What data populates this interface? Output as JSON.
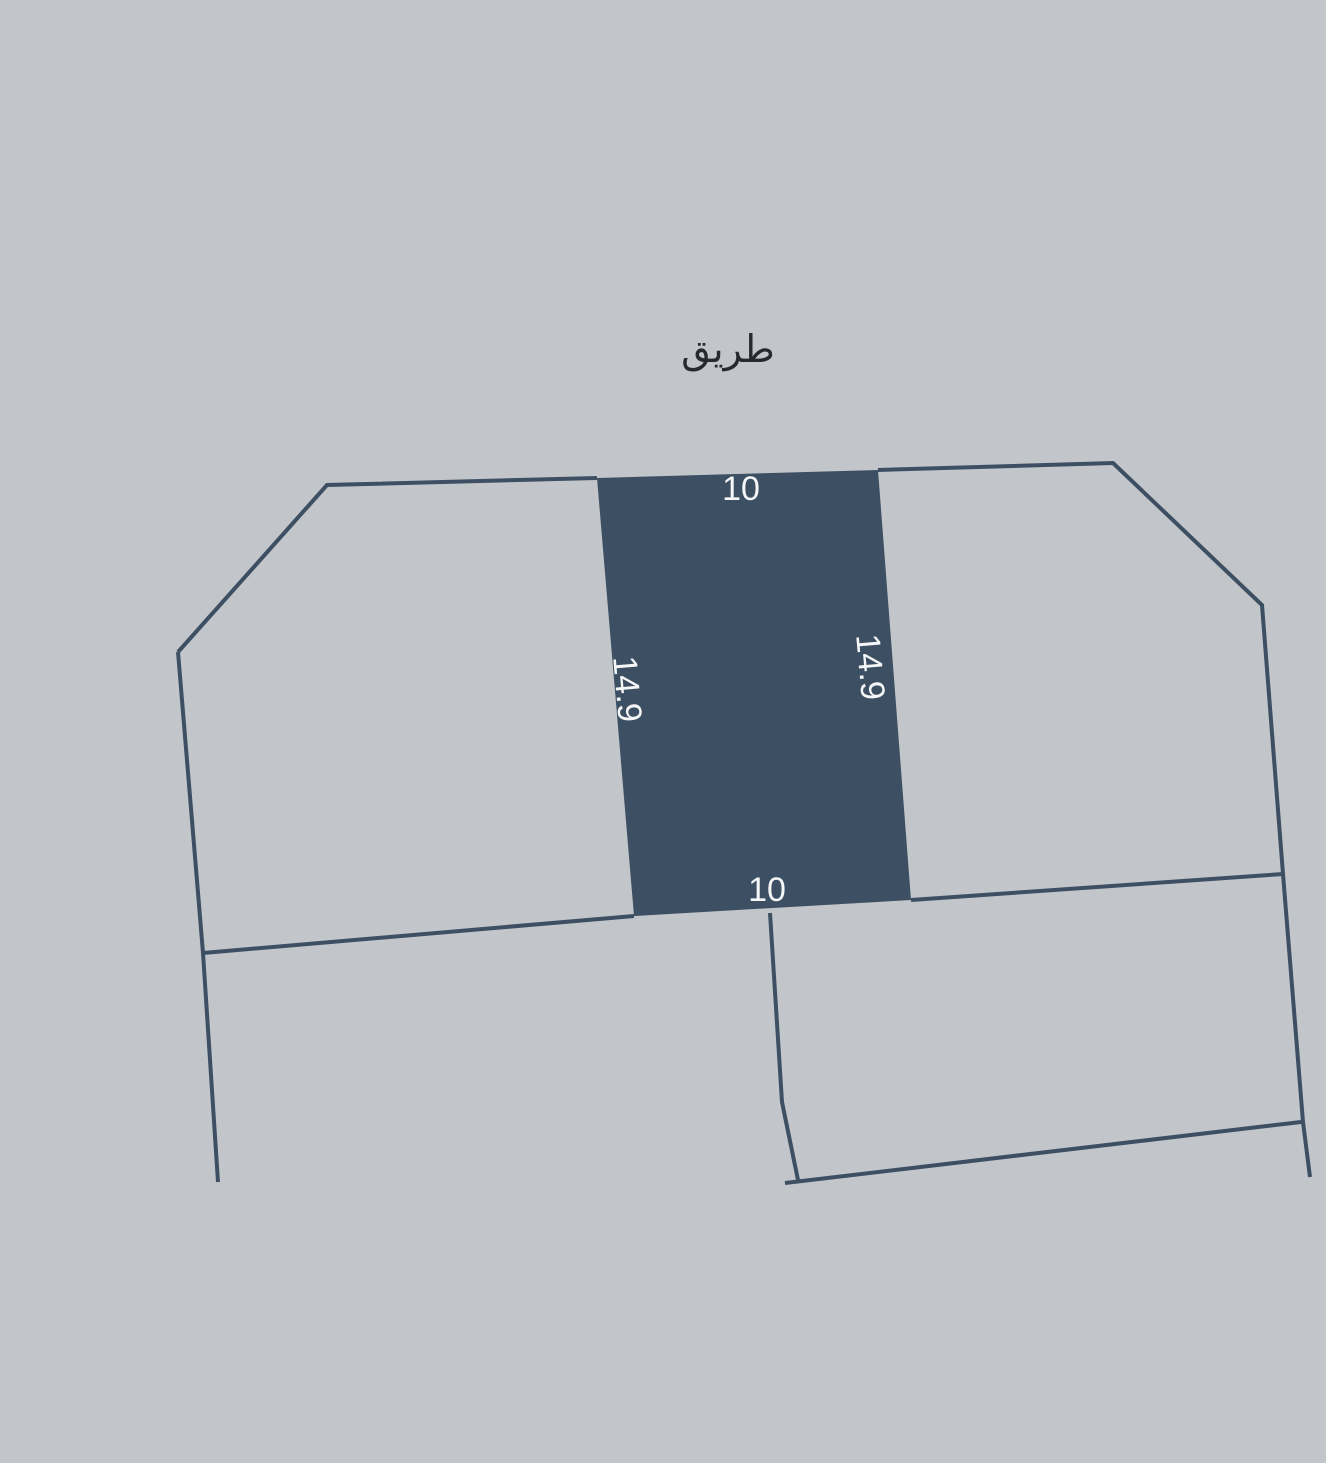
{
  "canvas": {
    "width": 1326,
    "height": 1463
  },
  "colors": {
    "background": "#c2c6ca",
    "parcel_fill": "#3d4f62",
    "boundary_line": "#3d4f62",
    "dimension_text": "#f4f6f7",
    "road_text": "#26292d"
  },
  "road": {
    "label": "طريق",
    "x": 728,
    "y": 349
  },
  "highlighted_parcel": {
    "points": "597,478 878,470 911,900 634,916",
    "dimensions": [
      {
        "text": "10",
        "x": 741,
        "y": 489,
        "transform": ""
      },
      {
        "text": "14.9",
        "x": 627,
        "y": 689,
        "transform": "rotate(85 627 689)"
      },
      {
        "text": "14.9",
        "x": 870,
        "y": 667,
        "transform": "rotate(85 870 667)"
      },
      {
        "text": "10",
        "x": 767,
        "y": 890,
        "transform": ""
      }
    ]
  },
  "boundaries": [
    {
      "name": "left-parcel-north-outline",
      "points": "178,652 327,485 597,478"
    },
    {
      "name": "left-parcel-west-edge",
      "points": "178,652 203,953 218,1182"
    },
    {
      "name": "south-boundary-west",
      "points": "203,953 634,916"
    },
    {
      "name": "right-parcel-outline",
      "points": "878,470 1113,463 1262,605 1283,874 1303,1122 1310,1177"
    },
    {
      "name": "south-boundary-east",
      "points": "911,900 1283,874"
    },
    {
      "name": "lower-right-parcel-west-edge",
      "points": "770,913 782,1102 798,1180"
    },
    {
      "name": "lower-right-parcel-south-edge",
      "points": "785,1183 1301,1122"
    }
  ]
}
